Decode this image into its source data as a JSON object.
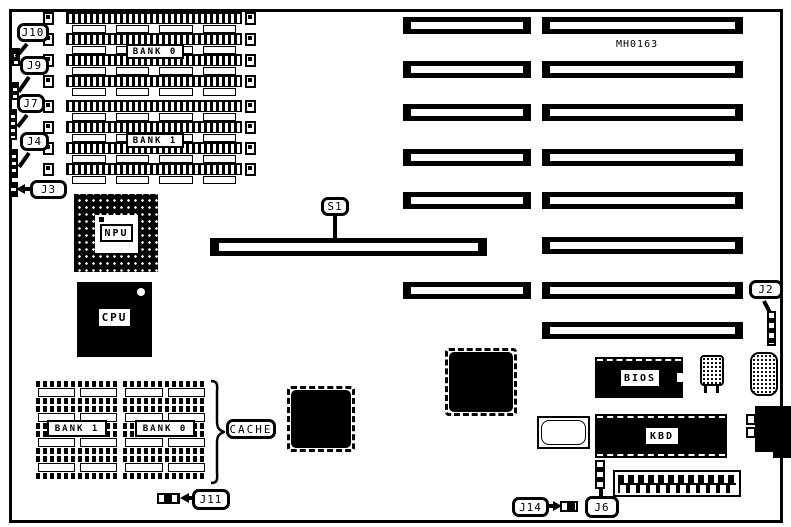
{
  "board_id": "MH0163",
  "callouts": {
    "j10": "J10",
    "j9": "J9",
    "j7": "J7",
    "j4": "J4",
    "j3": "J3",
    "s1": "S1",
    "j2": "J2",
    "j11": "J11",
    "j14": "J14",
    "j6": "J6"
  },
  "chips": {
    "npu": "NPU",
    "cpu": "CPU",
    "bios": "BIOS",
    "kbd": "KBD"
  },
  "simm": {
    "bank_top": "BANK 0",
    "bank_bottom": "BANK 1"
  },
  "cache": {
    "label": "CACHE",
    "bank_left": "BANK 1",
    "bank_right": "BANK 0"
  },
  "colors": {
    "ink": "#000000",
    "paper": "#ffffff"
  }
}
